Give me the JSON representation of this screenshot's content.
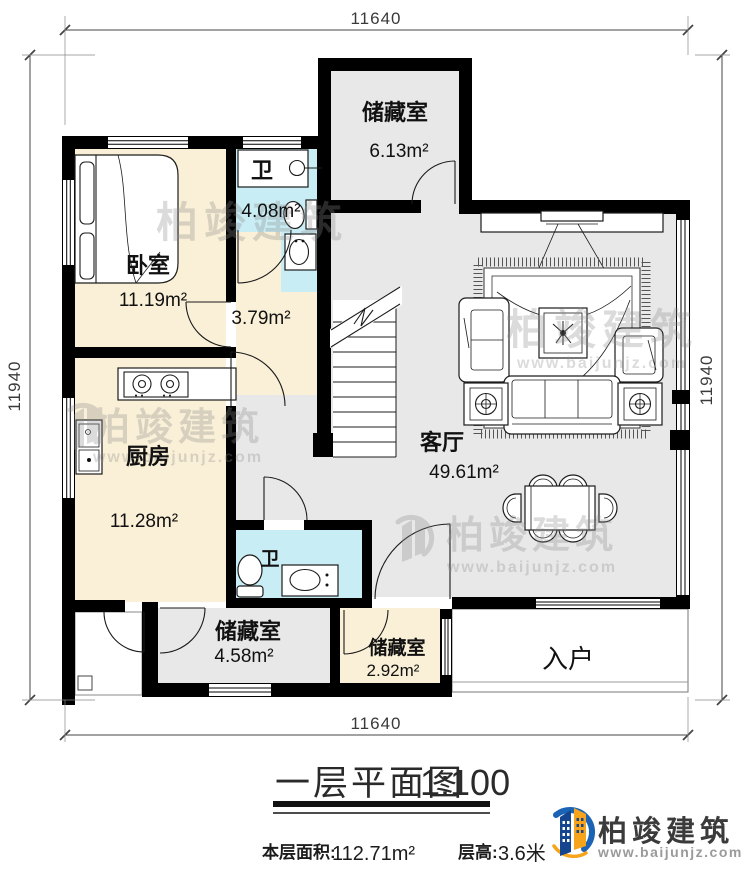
{
  "plan": {
    "dimensions": {
      "top": "11640",
      "bottom": "11640",
      "left": "11940",
      "right": "11940"
    },
    "rooms": {
      "storage_top": {
        "name": "储藏室",
        "area": "6.13m²"
      },
      "bedroom": {
        "name": "卧室",
        "area": "11.19m²"
      },
      "bath1": {
        "name": "卫",
        "area": "4.08m²"
      },
      "corridor": {
        "area": "3.79m²"
      },
      "kitchen": {
        "name": "厨房",
        "area": "11.28m²"
      },
      "living": {
        "name": "客厅",
        "area": "49.61m²"
      },
      "bath2": {
        "name": "卫"
      },
      "storage_mid": {
        "name": "储藏室",
        "area": "4.58m²"
      },
      "storage_small": {
        "name": "储藏室",
        "area": "2.92m²"
      },
      "entry": {
        "name": "入户"
      }
    }
  },
  "title": {
    "text": "一层平面图",
    "scale": "1:100"
  },
  "info": {
    "floor_area_label": "本层面积:",
    "floor_area_value": "112.71m²",
    "floor_height_label": "层高:",
    "floor_height_value": "3.6米"
  },
  "brand": {
    "name": "柏竣建筑",
    "url": "www.baijunjz.com"
  },
  "watermark": {
    "name": "柏竣建筑",
    "url": "www.baijunjz.com"
  },
  "colors": {
    "wall": "#000000",
    "beige": "#faf0d7",
    "cyan": "#c9edf5",
    "gray": "#e8e8e8",
    "brand_blue": "#1a63b5",
    "brand_navy": "#16458f",
    "brand_orange": "#f7a41d"
  }
}
